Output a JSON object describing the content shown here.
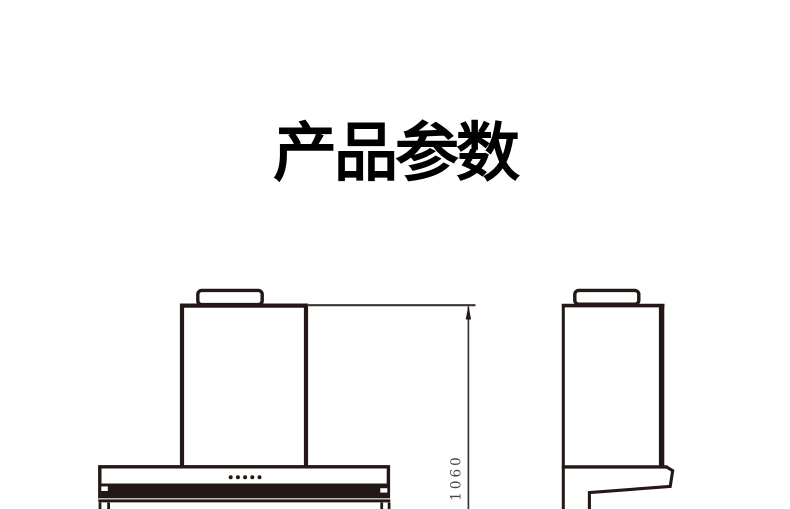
{
  "title": {
    "text": "产品参数",
    "color": "#000000"
  },
  "diagram": {
    "stroke_color": "#231815",
    "background_color": "#ffffff",
    "dimension": {
      "label": "1060",
      "orientation": "vertical",
      "text_color": "#4a4340"
    },
    "front_view": {
      "name": "range-hood-front-view",
      "control_dot_count": 5
    },
    "side_view": {
      "name": "range-hood-side-view"
    }
  }
}
